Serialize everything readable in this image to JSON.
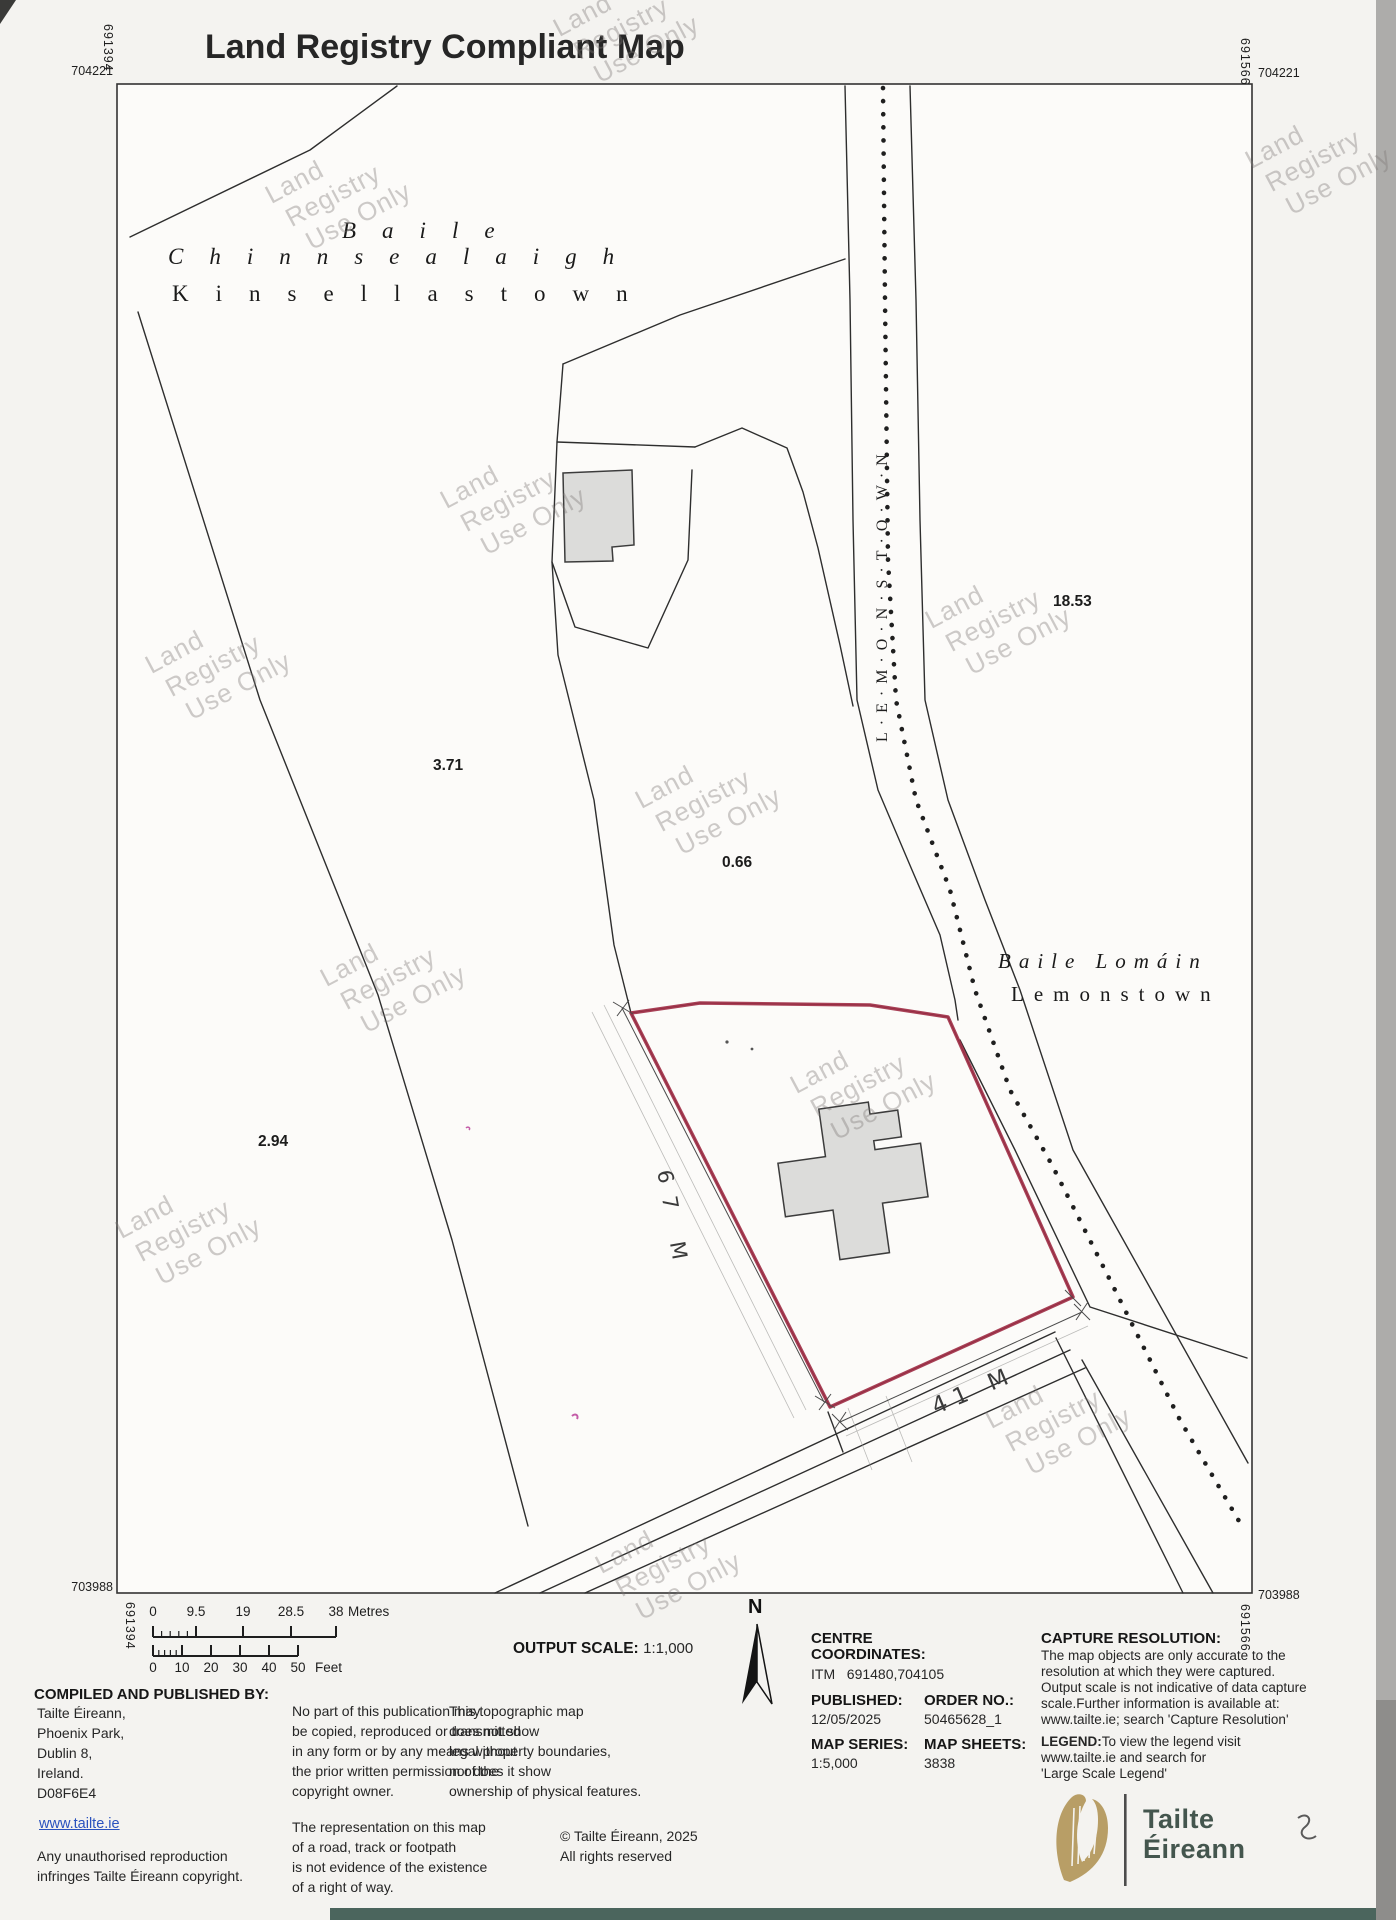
{
  "title": "Land Registry Compliant Map",
  "colors": {
    "red_boundary": "#9e2b44",
    "watermark": "rgba(125,122,118,0.38)",
    "link": "#2a52be",
    "logo_text": "#44564e",
    "harp_gold": "#b2975a",
    "teal_strip": "#4b655d"
  },
  "corner_coords": {
    "top_left_easting": "691394",
    "top_left_northing": "704221",
    "top_right_easting": "691566",
    "top_right_northing": "704221",
    "bottom_left_easting": "691394",
    "bottom_left_northing": "703988",
    "bottom_right_easting": "691566",
    "bottom_right_northing": "703988"
  },
  "map": {
    "townland_north": {
      "irish_line1": "Baile",
      "irish_line2": "Chinnsealaigh",
      "english": "Kinsellastown"
    },
    "townland_east": {
      "irish": "Baile Lomáin",
      "english": "Lemonstown"
    },
    "road_label": "L·E·M·O·N·S·T·O·W·N",
    "dimension_west": "67 M",
    "dimension_south": "41 M",
    "area_labels": [
      {
        "value": "3.71",
        "x": 433,
        "y": 757
      },
      {
        "value": "0.66",
        "x": 722,
        "y": 854
      },
      {
        "value": "2.94",
        "x": 258,
        "y": 1133
      },
      {
        "value": "18.53",
        "x": 1053,
        "y": 593
      }
    ],
    "watermark_lines": [
      "Land",
      "Registry",
      "Use Only"
    ],
    "watermark_positions": [
      [
        608,
        58
      ],
      [
        320,
        225
      ],
      [
        1300,
        190
      ],
      [
        495,
        530
      ],
      [
        980,
        650
      ],
      [
        200,
        695
      ],
      [
        690,
        830
      ],
      [
        375,
        1008
      ],
      [
        845,
        1115
      ],
      [
        170,
        1260
      ],
      [
        1040,
        1450
      ],
      [
        650,
        1595
      ]
    ]
  },
  "scalebar": {
    "metres": {
      "labels": [
        "0",
        "9.5",
        "19",
        "28.5",
        "38"
      ],
      "xs": [
        153,
        196,
        243,
        291,
        336
      ],
      "unit": "Metres"
    },
    "feet": {
      "labels": [
        "0",
        "10",
        "20",
        "30",
        "40",
        "50"
      ],
      "xs": [
        153,
        182,
        211,
        240,
        269,
        298
      ],
      "unit": "Feet"
    }
  },
  "legend": {
    "output_scale_label": "OUTPUT SCALE:",
    "output_scale_value": "1:1,000",
    "north": "N",
    "compiled_header": "COMPILED AND PUBLISHED BY:",
    "address": [
      "Tailte Éireann,",
      "Phoenix Park,",
      "Dublin 8,",
      "Ireland.",
      "D08F6E4"
    ],
    "website": "www.tailte.ie",
    "unauthorised": [
      "Any unauthorised reproduction",
      "infringes Tailte Éireann copyright."
    ],
    "no_part": [
      "No part of this publication may",
      "be copied, reproduced or transmitted",
      "in any form or by any means without",
      "the prior written permission of the",
      "copyright owner."
    ],
    "representation": [
      "The representation on this map",
      "of a road, track or footpath",
      "is not evidence of the existence",
      "of a right of way."
    ],
    "topographic": [
      "This topographic map",
      "does not show",
      "legal property boundaries,",
      "nor does it show",
      "ownership of physical features."
    ],
    "copyright": [
      "© Tailte Éireann, 2025",
      "All rights reserved"
    ],
    "centre": {
      "l1": "CENTRE",
      "l2": "COORDINATES:",
      "l3_label": "ITM",
      "l3_value": "691480,704105"
    },
    "published": {
      "label": "PUBLISHED:",
      "value": "12/05/2025"
    },
    "order": {
      "label": "ORDER NO.:",
      "value": "50465628_1"
    },
    "series": {
      "label": "MAP SERIES:",
      "value": "1:5,000"
    },
    "sheets": {
      "label": "MAP SHEETS:",
      "value": "3838"
    },
    "capture": {
      "header": "CAPTURE RESOLUTION:",
      "lines": [
        "The map objects are only accurate to the",
        "resolution at which they were captured.",
        "Output scale is not indicative of data capture",
        "scale.Further information is available at:",
        "www.tailte.ie; search 'Capture Resolution'"
      ]
    },
    "legend_note": {
      "l1_bold": "LEGEND:",
      "l1_rest": "To view the legend visit",
      "l2": "www.tailte.ie and search for",
      "l3": "'Large Scale Legend'"
    }
  },
  "logo": {
    "name_line1": "Tailte",
    "name_line2": "Éireann"
  }
}
